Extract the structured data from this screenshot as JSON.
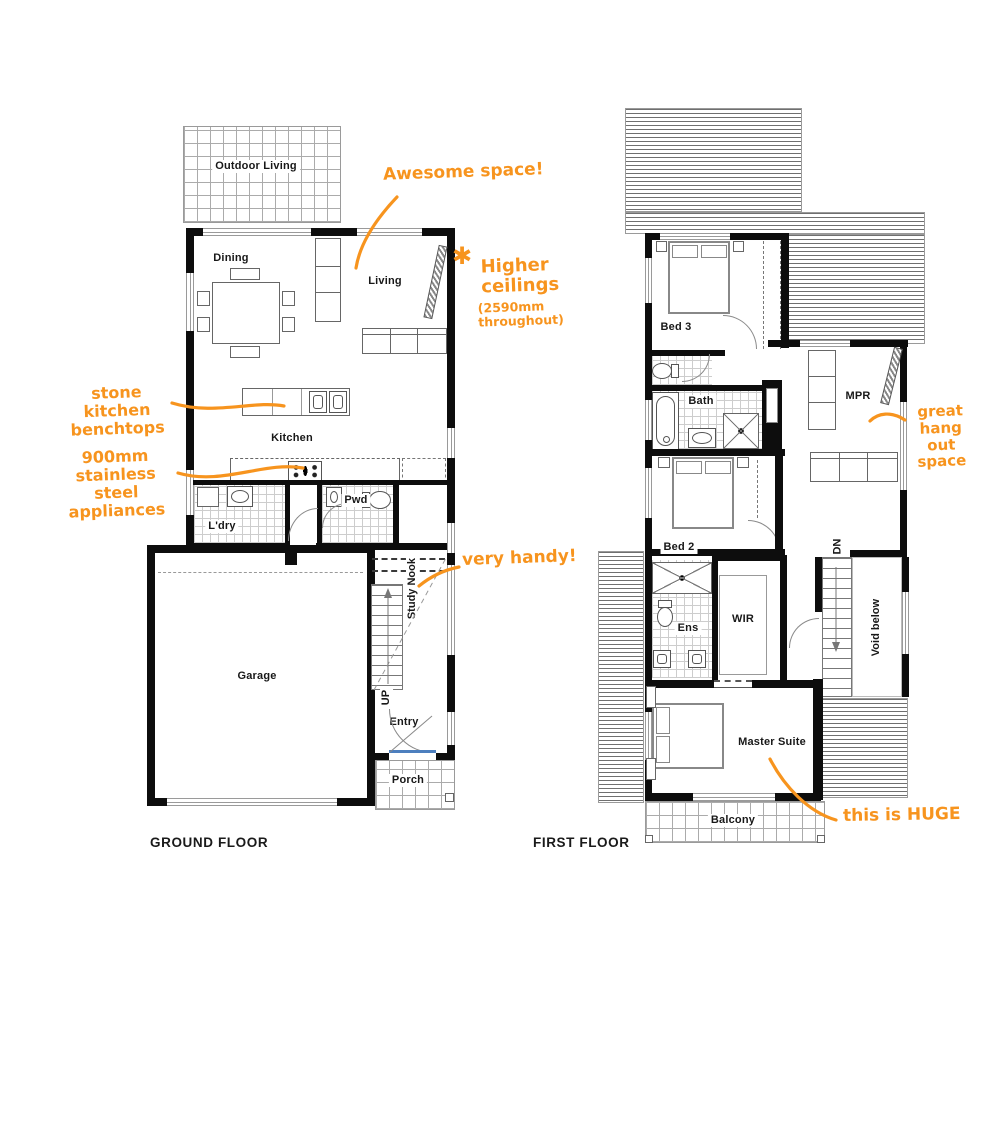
{
  "colors": {
    "annotation_orange": "#f7941e",
    "wall_black": "#0d0d0d"
  },
  "ground_floor": {
    "title": "GROUND FLOOR",
    "rooms": {
      "outdoor_living": "Outdoor Living",
      "dining": "Dining",
      "living": "Living",
      "kitchen": "Kitchen",
      "laundry": "L'dry",
      "powder": "Pwd",
      "garage": "Garage",
      "study_nook": "Study Nook",
      "entry": "Entry",
      "porch": "Porch",
      "stairs_up": "UP"
    }
  },
  "first_floor": {
    "title": "FIRST FLOOR",
    "rooms": {
      "bed3": "Bed 3",
      "bath": "Bath",
      "mpr": "MPR",
      "bed2": "Bed 2",
      "ensuite": "Ens",
      "wir": "WIR",
      "stairs_down": "DN",
      "void_below": "Void below",
      "master_suite": "Master Suite",
      "balcony": "Balcony"
    }
  },
  "annotations": {
    "awesome_space": "Awesome space!",
    "higher_ceilings_heading": "Higher ceilings",
    "higher_ceilings_detail": "(2590mm throughout)",
    "stone_benchtops": "stone kitchen benchtops",
    "appliances": "900mm stainless steel appliances",
    "very_handy": "very handy!",
    "hang_out_space": "great hang out space",
    "huge": "this is HUGE"
  },
  "icons": {
    "asterisk": "✱"
  }
}
